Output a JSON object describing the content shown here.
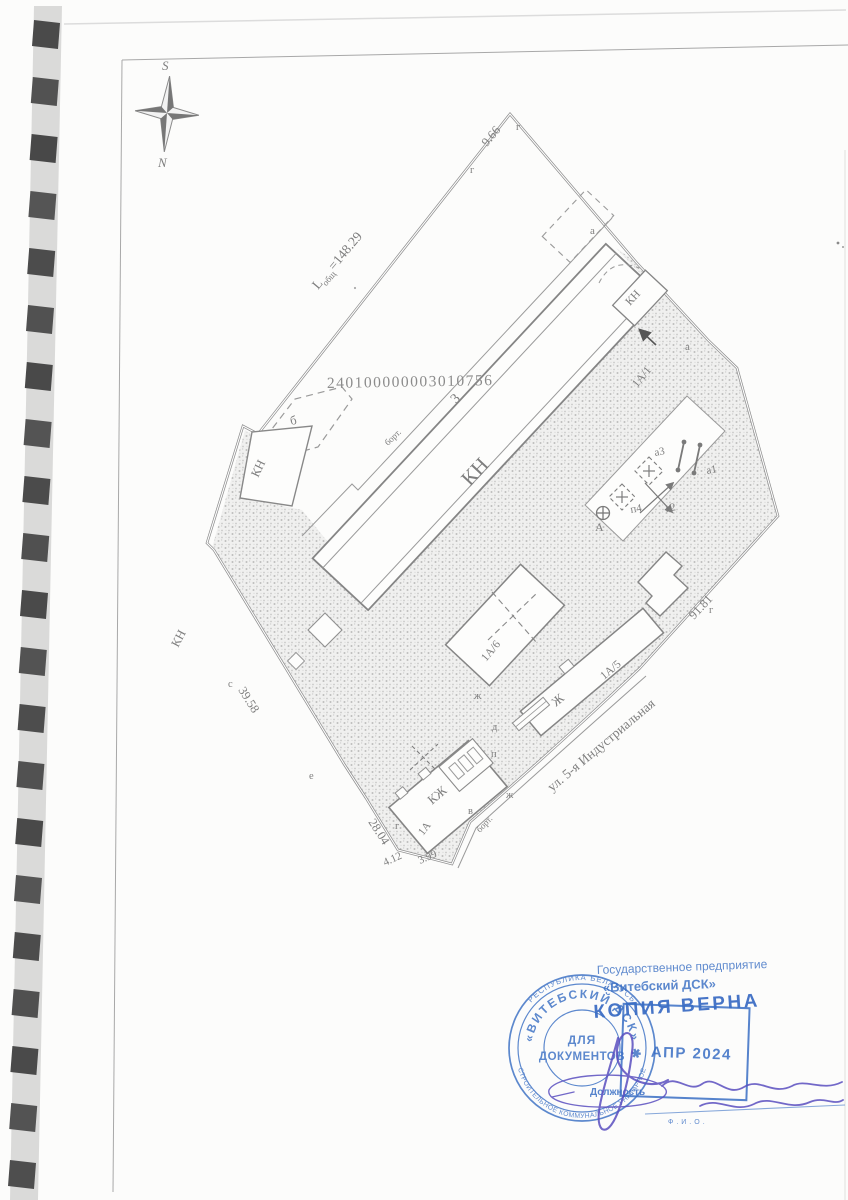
{
  "compass": {
    "south": "S",
    "north": "N"
  },
  "plan": {
    "cadastral_number": "240100000003010756",
    "length_total_prefix": "L",
    "length_total_sub": "общ",
    "length_total_value": "=148.29",
    "len_9_66": "9.66",
    "len_91_81": "91.81",
    "len_39_58": "39.58",
    "len_28_04": "28.04",
    "len_4_12": "4.12",
    "len_3_99": "3.99",
    "street": "ул. 5-я Индустриальная",
    "curb": "борт.",
    "bld_main_num": "3",
    "bld_main_type": "КН",
    "bld_left_type": "КН",
    "bld_box_type": "КН",
    "adjacent_parcel": "КН",
    "bld_b": "б",
    "unit_1a1": "1А/1",
    "unit_1a6": "1А/6",
    "unit_1a5": "1А/5",
    "unit_zh": "Ж",
    "bld_kzh": "КЖ",
    "unit_1a": "1А",
    "sym_a1": "а1",
    "sym_a2": "а2",
    "sym_a3": "а3",
    "sym_p4": "п4",
    "sym_A": "А",
    "pt_g": "г",
    "pt_a": "а",
    "pt_e": "е",
    "pt_v": "в",
    "pt_zh": "ж",
    "pt_d": "д",
    "pt_p": "п",
    "pt_s": "с"
  },
  "stamps": {
    "org_line1": "Государственное предприятие",
    "org_line2": "«Витебский ДСК»",
    "copy_mark": "КОПИЯ ВЕРНА",
    "round_outer_top": "РЕСПУБЛИКА БЕЛАРУСЬ",
    "round_outer_bottom": "СТРОИТЕЛЬНОЕ КОММУНАЛЬНОЕ УНИТАРНОЕ",
    "round_middle": "✱ «ВИТЕБСКИЙ ДСК» ✱",
    "round_center1": "ДЛЯ",
    "round_center2": "ДОКУМЕНТОВ",
    "date": "АПР 2024",
    "position_label": "Должность",
    "fio_label": "Ф.И.О.",
    "ink_blue": "#3a6fc4",
    "ink_violet": "#5a4fc0"
  }
}
